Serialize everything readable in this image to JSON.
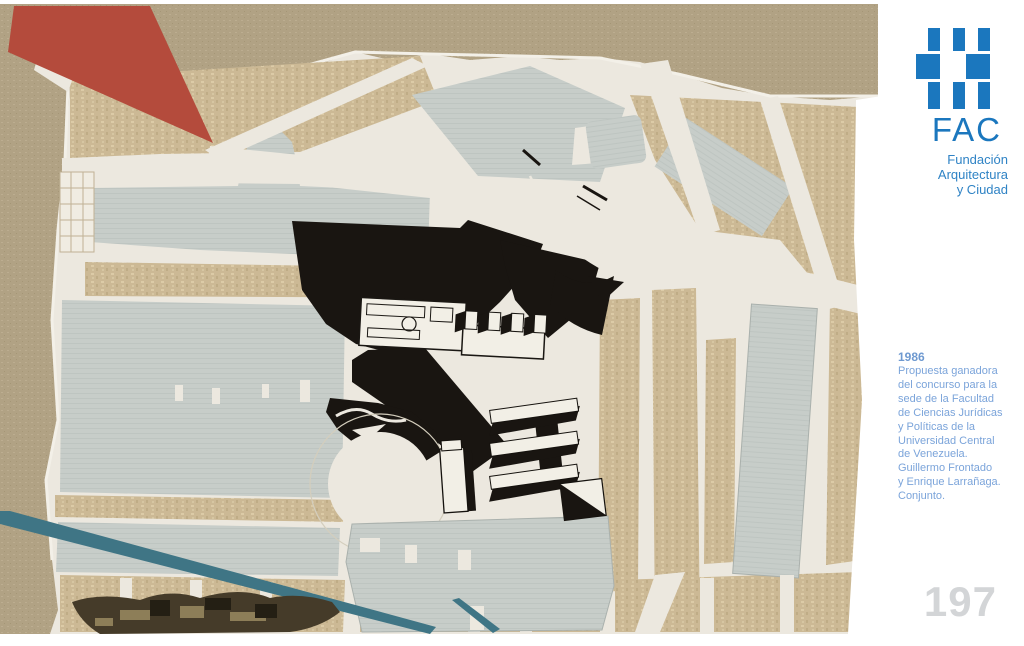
{
  "artwork": {
    "palette": {
      "paper_khaki": "#b1a284",
      "map_cream": "#ece8df",
      "block_tan": "#ccb995",
      "block_gray": "#c7cdc9",
      "plan_black": "#191511",
      "triangle_red": "#b44b3c",
      "tape_teal": "#3f7585",
      "photo_brown": "#453b29"
    }
  },
  "sidebar": {
    "logo": {
      "acronym": "FAC",
      "name_lines": [
        "Fundación",
        "Arquitectura",
        "y Ciudad"
      ],
      "brand_blue": "#1b77be"
    },
    "caption": {
      "year": "1986",
      "lines": [
        "Propuesta ganadora",
        "del concurso para la",
        "sede de la Facultad",
        "de Ciencias Jurídicas",
        "y Políticas de la",
        "Universidad Central",
        "de Venezuela.",
        "Guillermo Frontado",
        "y Enrique Larrañaga.",
        "Conjunto."
      ],
      "text_blue": "#7ba4da"
    },
    "page_number": "197",
    "page_number_color": "#d3d5d7"
  }
}
